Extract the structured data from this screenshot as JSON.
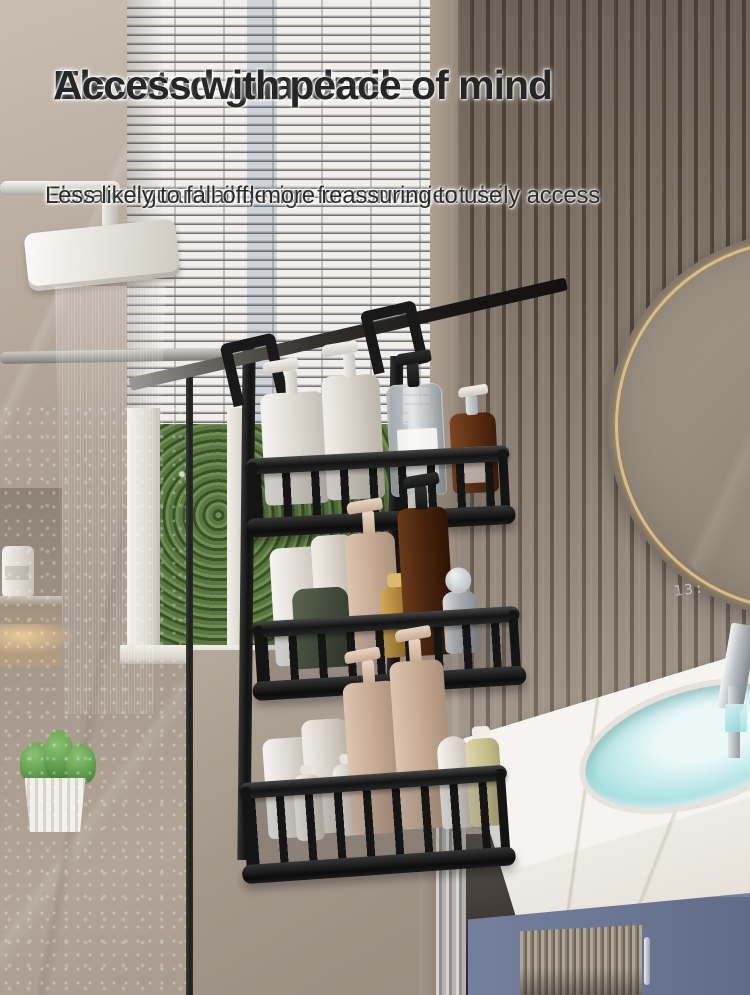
{
  "overlay": {
    "heading_line1": "Elevated guardrail",
    "heading_line2": "Access with peace of mind",
    "subheading_line1": "Elevated guardrail design for convenient daily access",
    "subheading_line2": "Less likely to fall off, more reassuring to use"
  },
  "mirror": {
    "clock_text": "13:"
  },
  "palette": {
    "text_dark": "#262626",
    "caddy_black": "#1a1a1a",
    "mirror_gold_rim": "#dcbd80",
    "cabinet_blue": "#6b7692",
    "sink_water_blue": "#9adfe2",
    "marble_taupe": "#b0a396",
    "slat_wall_brown": "#8a7e71",
    "foliage_green": "#4c6438",
    "blinds_white": "#f1efeb",
    "amber_bottle": "#5a2c10",
    "beige_bottle": "#c5a993",
    "green_jar": "#424b3a",
    "gold_bottle": "#a57b32",
    "counter_white": "#f6f4f0"
  }
}
